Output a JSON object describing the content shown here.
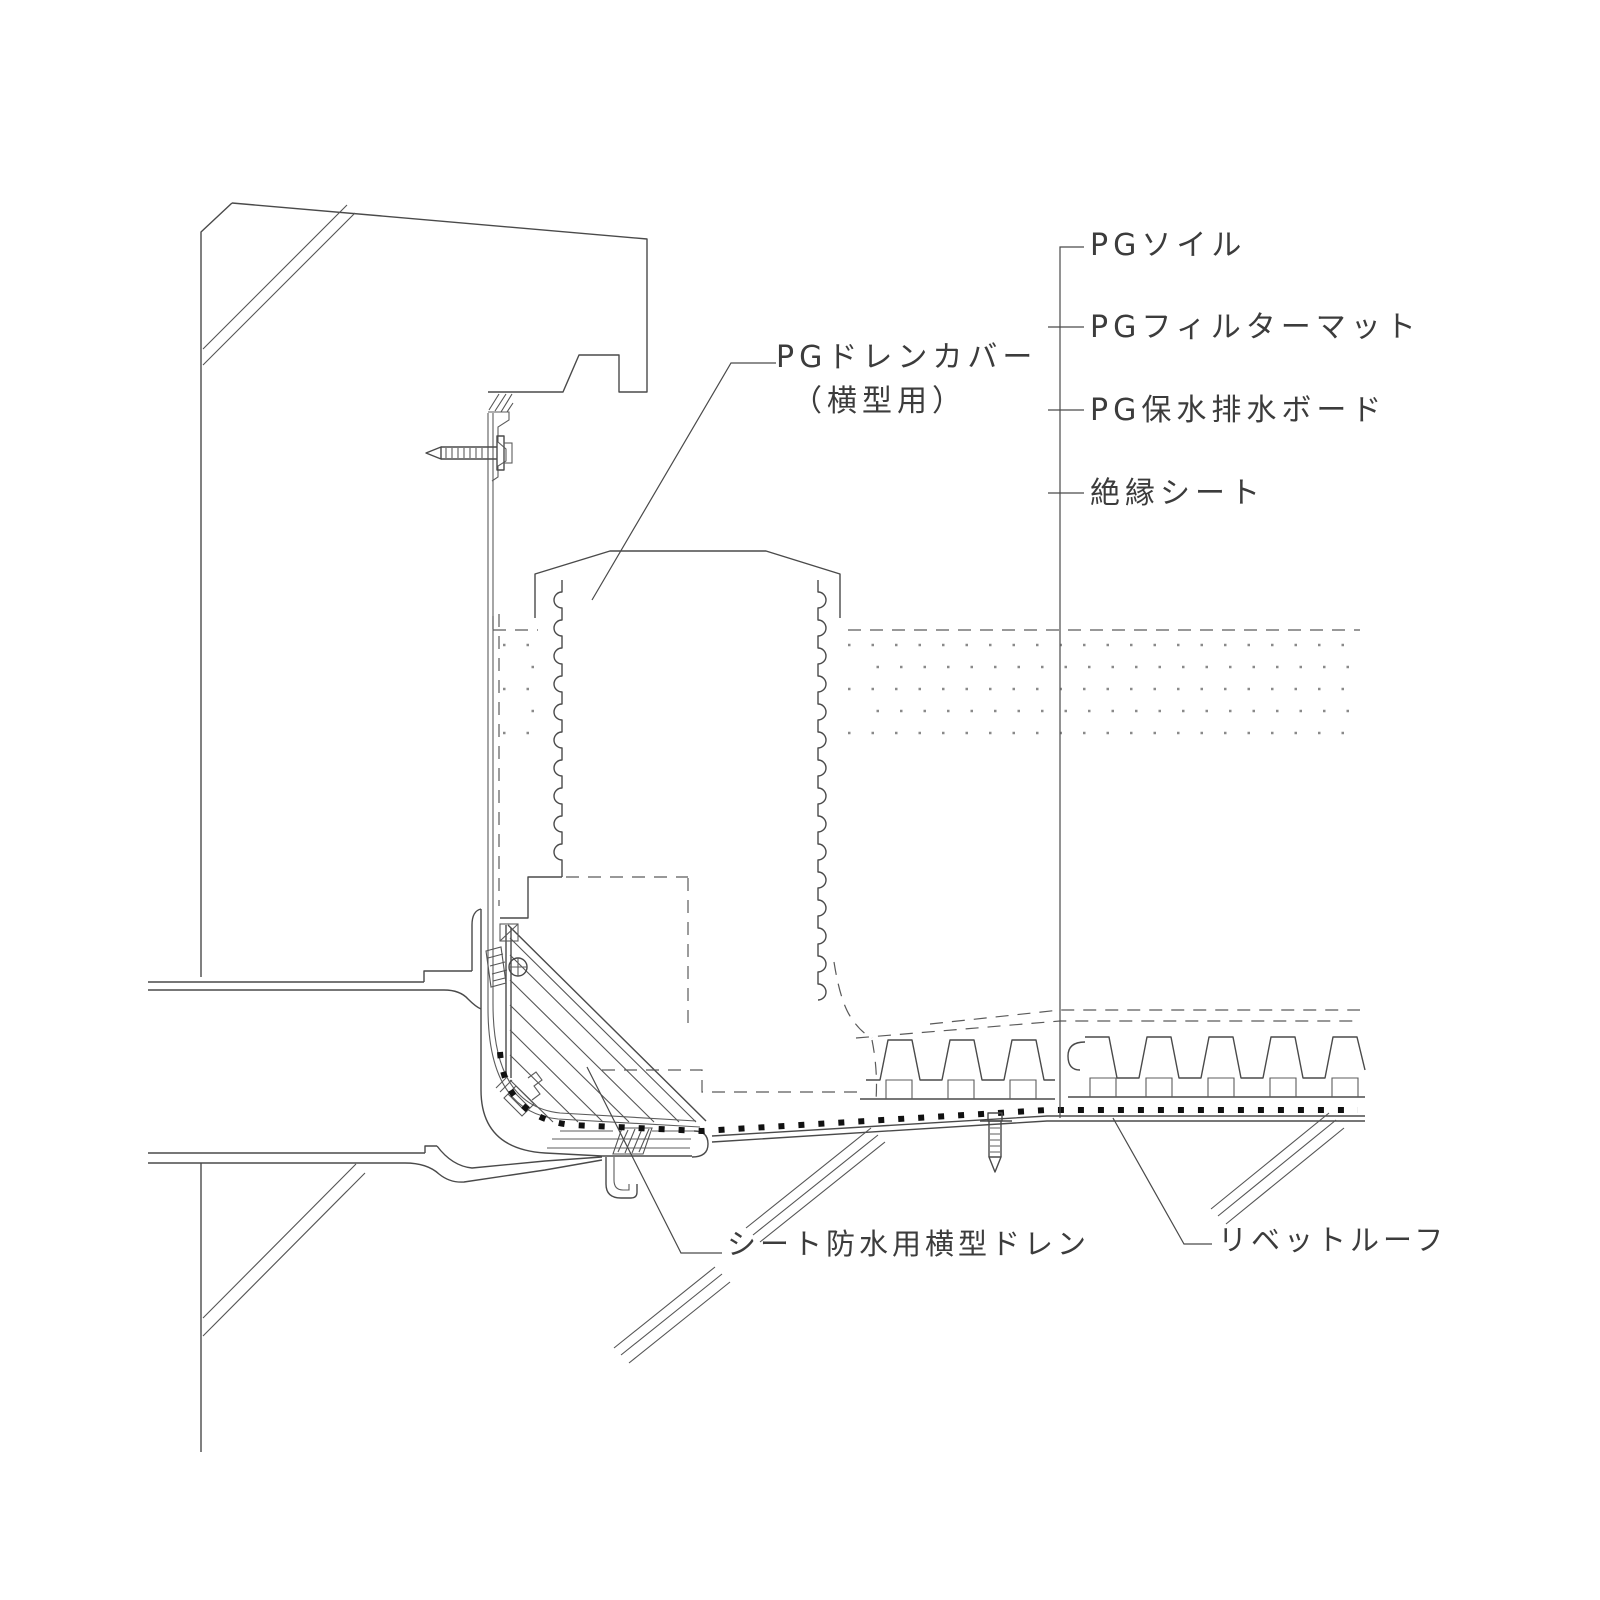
{
  "drawing_title": "横型ドレン納まり詳細図",
  "labels": {
    "soil": "PGソイル",
    "filter_mat": "PGフィルターマット",
    "drain_board": "PG保水排水ボード",
    "insulation_sheet": "絶縁シート",
    "drain_cover_line1": "PGドレンカバー",
    "drain_cover_line2": "（横型用）",
    "sheet_drain": "シート防水用横型ドレン",
    "rivet_roof": "リベットルーフ"
  },
  "colors": {
    "background": "#ffffff",
    "line": "#4a4a4a",
    "rivet_dots": "#111111"
  }
}
